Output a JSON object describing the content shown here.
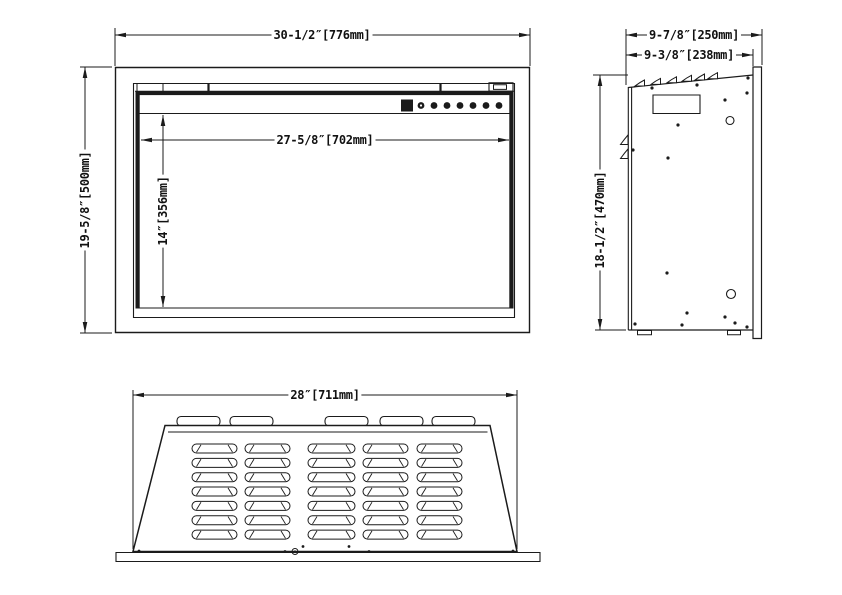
{
  "drawing": {
    "title": "fireplace-insert-dimension-drawing",
    "colors": {
      "line": "#1b1b1b",
      "background": "#ffffff"
    },
    "front": {
      "overall_width": "30-1/2″[776mm]",
      "overall_height": "19-5/8″[500mm]",
      "opening_width": "27-5/8″[702mm]",
      "opening_height": "14″[356mm]"
    },
    "side": {
      "overall_depth": "9-7/8″[250mm]",
      "body_depth": "9-3/8″[238mm]",
      "height": "18-1/2″[470mm]"
    },
    "top": {
      "width": "28″[711mm]"
    }
  }
}
